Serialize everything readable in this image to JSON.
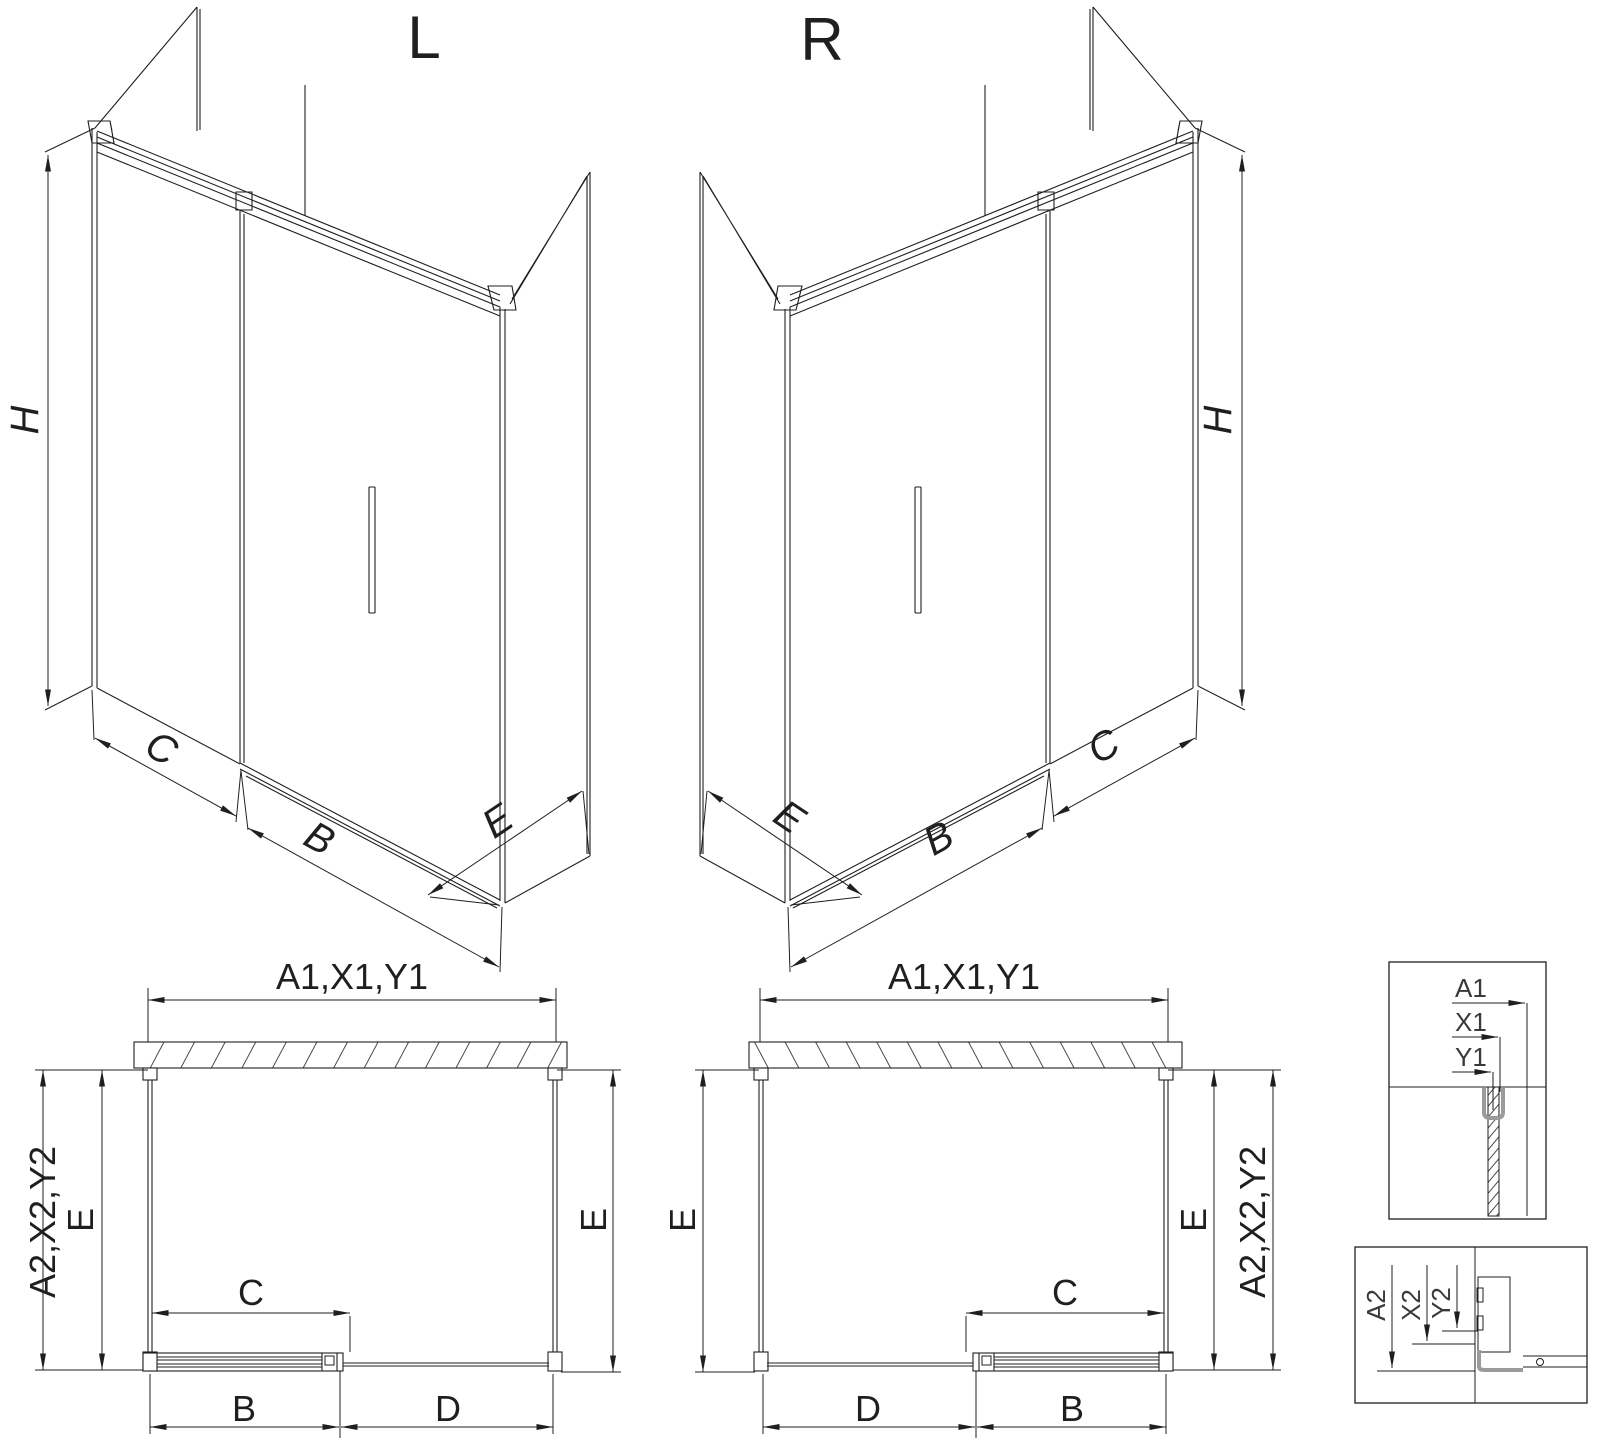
{
  "colors": {
    "line": "#1f1f1f",
    "detail_grey": "#9b9b9b",
    "background": "#ffffff"
  },
  "iso_left": {
    "title": "L",
    "height_label": "H",
    "panel_label": "C",
    "door_label": "B",
    "side_label": "E"
  },
  "iso_right": {
    "title": "R",
    "height_label": "H",
    "panel_label": "C",
    "door_label": "B",
    "side_label": "E"
  },
  "plan_left": {
    "width_label": "A1,X1,Y1",
    "outer_depth_label": "A2,X2,Y2",
    "depth_left_label": "E",
    "depth_right_label": "E",
    "travel_label": "C",
    "door_label": "B",
    "fixed_label": "D"
  },
  "plan_right": {
    "width_label": "A1,X1,Y1",
    "outer_depth_label": "A2,X2,Y2",
    "depth_left_label": "E",
    "depth_right_label": "E",
    "travel_label": "C",
    "door_label": "B",
    "fixed_label": "D"
  },
  "detail_top": {
    "a1": "A1",
    "x1": "X1",
    "y1": "Y1"
  },
  "detail_bottom": {
    "a2": "A2",
    "x2": "X2",
    "y2": "Y2"
  }
}
